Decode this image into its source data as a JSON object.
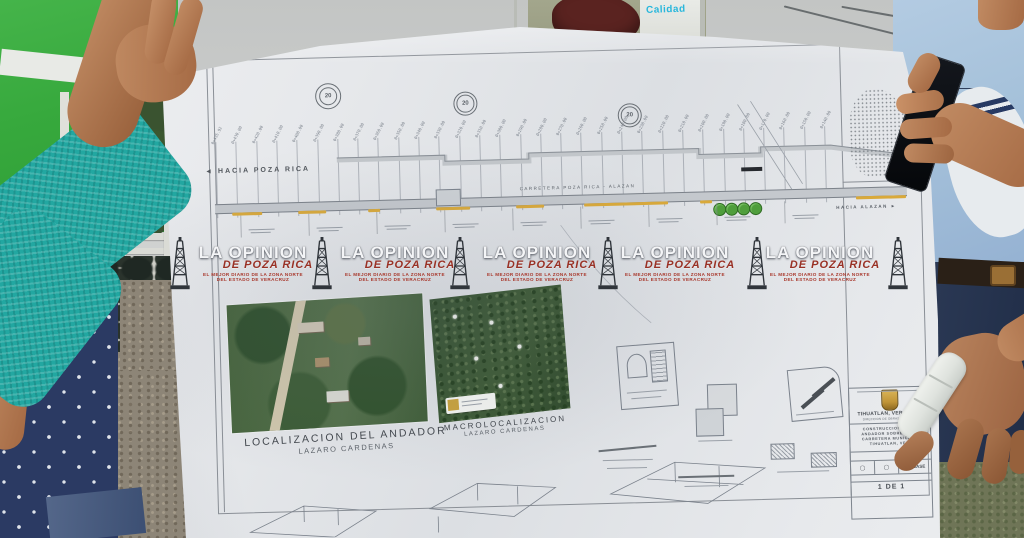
{
  "photo": {
    "background_sign": "Calidad"
  },
  "watermark": {
    "line1": "LA OPINION",
    "line2": "DE POZA RICA",
    "line3": "EL MEJOR DIARIO DE LA ZONA NORTE",
    "line4": "DEL ESTADO DE VERACRUZ",
    "count": 5
  },
  "plan": {
    "direction_left": "HACIA POZA RICA",
    "direction_right": "HACIA ALAZAN",
    "road_label": "CARRETERA POZA RICA - ALAZAN",
    "callout_text": "20",
    "stations": [
      "0+435.92",
      "0+430.00",
      "0+420.00",
      "0+410.00",
      "0+400.00",
      "0+390.00",
      "0+380.00",
      "0+370.00",
      "0+360.00",
      "0+350.00",
      "0+340.00",
      "0+330.00",
      "0+320.00",
      "0+310.00",
      "0+300.00",
      "0+290.00",
      "0+280.00",
      "0+270.00",
      "0+260.00",
      "0+250.00",
      "0+240.00",
      "0+230.00",
      "0+220.00",
      "0+210.00",
      "0+200.00",
      "0+190.00",
      "0+180.00",
      "0+170.00",
      "0+160.00",
      "0+150.00",
      "0+140.00"
    ],
    "insets": {
      "localizacion": {
        "title": "LOCALIZACION DEL ANDADOR",
        "subtitle": "LAZARO CARDENAS"
      },
      "macrolocalizacion": {
        "title": "MACROLOCALIZACION",
        "subtitle": "LAZARO CARDENAS"
      }
    },
    "title_block": {
      "municipality": "TIHUATLAN, VERACRUZ",
      "department": "DIRECCION DE OBRAS PUBLICAS",
      "project_line1": "CONSTRUCCION DE UN",
      "project_line2": "ANDADOR SOBRE DE LA",
      "project_line3": "CARRETERA MUNICIPAL",
      "project_line4": "TIHUATLAN, VER.",
      "sheet_label": "PL. BASE",
      "sheet_number": "1 DE 1"
    },
    "colors": {
      "road_marking": "#d9a93a",
      "tree_green": "#4f9e3c",
      "watermark_red": "#a8372b"
    }
  }
}
